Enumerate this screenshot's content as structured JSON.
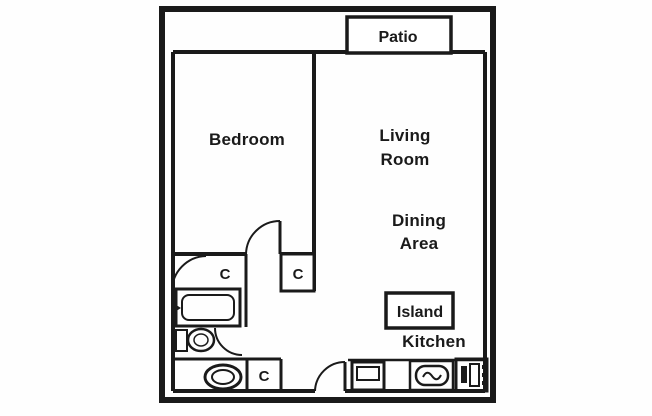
{
  "floor_plan": {
    "rooms": {
      "patio": "Patio",
      "bedroom": "Bedroom",
      "living_room": [
        "Living",
        "Room"
      ],
      "dining_area": [
        "Dining",
        "Area"
      ],
      "island": "Island",
      "kitchen": "Kitchen"
    },
    "closet_labels": {
      "bath_closet": "C",
      "hall_closet": "C",
      "entry_closet": "C"
    },
    "fixture_icons": [
      "bathtub-icon",
      "toilet-icon",
      "vanity-sink-icon",
      "kitchen-sink-icon",
      "stove-icon",
      "range-icon",
      "bedroom-door-swing",
      "closet-door-swing",
      "bathroom-door-swing",
      "entry-door-swing"
    ],
    "colors": {
      "line": "#1a1a1a",
      "background": "#ffffff"
    }
  }
}
